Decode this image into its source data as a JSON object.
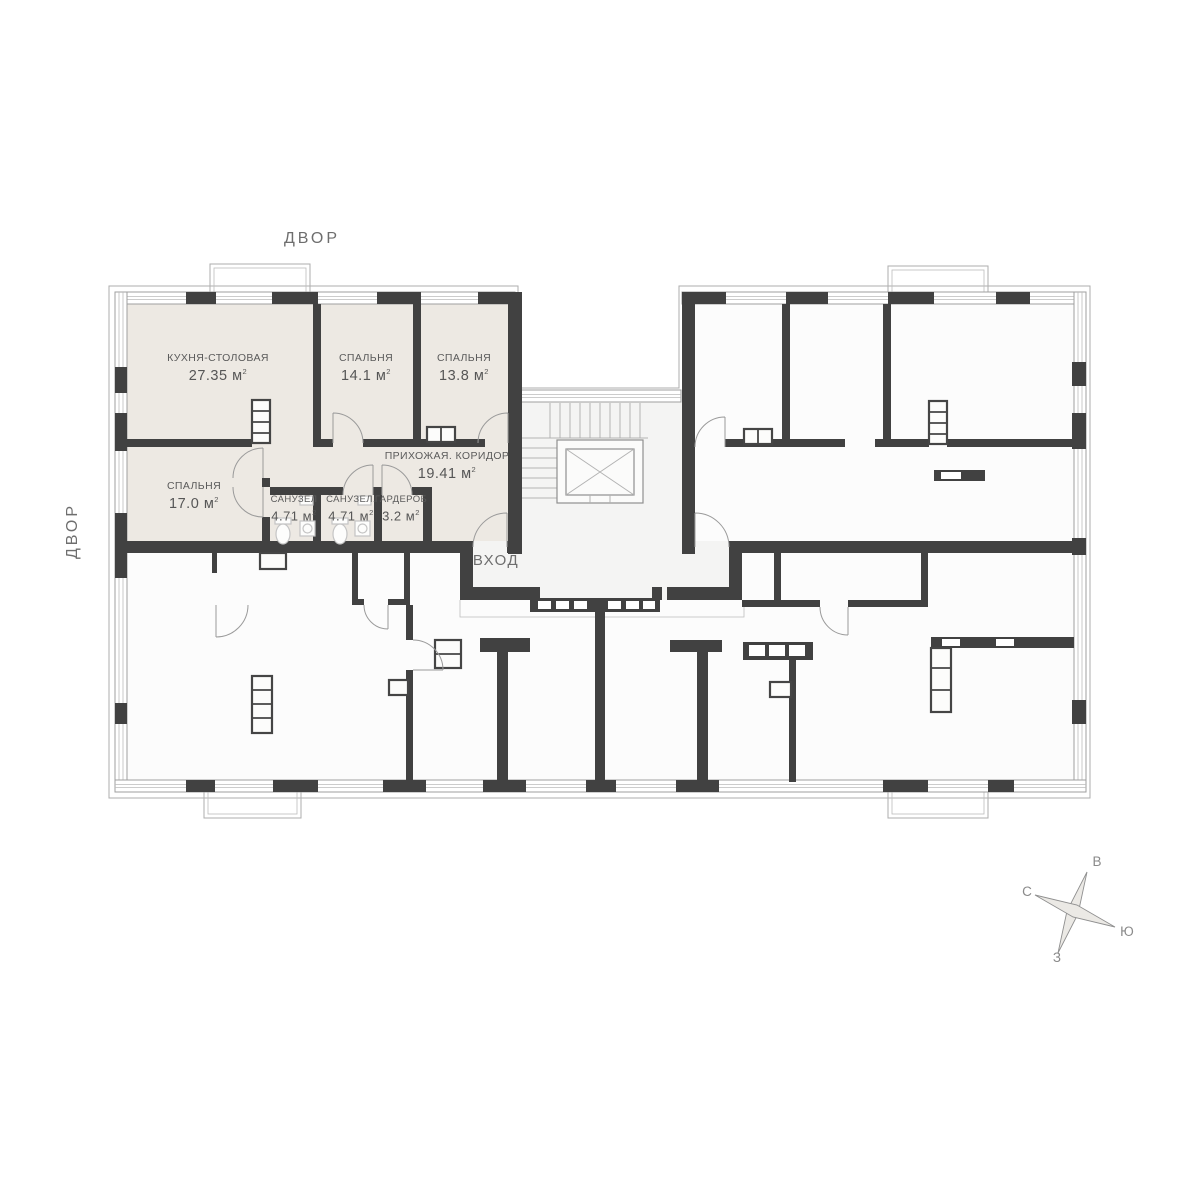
{
  "plan": {
    "courtyard_label_top": "ДВОР",
    "courtyard_label_left": "ДВОР",
    "entrance_label": "ВХОД",
    "area_unit_base": "м",
    "area_unit_sup": "2"
  },
  "apartment": {
    "highlight_color": "#ede9e3",
    "rooms": [
      {
        "id": "kitchen-dining",
        "name": "КУХНЯ-СТОЛОВАЯ",
        "area": "27.35"
      },
      {
        "id": "bedroom-1",
        "name": "СПАЛЬНЯ",
        "area": "14.1"
      },
      {
        "id": "bedroom-2",
        "name": "СПАЛЬНЯ",
        "area": "13.8"
      },
      {
        "id": "bedroom-3",
        "name": "СПАЛЬНЯ",
        "area": "17.0"
      },
      {
        "id": "bathroom-1",
        "name": "САНУЗЕЛ",
        "area": "4.71"
      },
      {
        "id": "bathroom-2",
        "name": "САНУЗЕЛ.",
        "area": "4.71"
      },
      {
        "id": "wardrobe",
        "name": "ГАРДЕРОБ",
        "area": "3.2"
      },
      {
        "id": "hallway",
        "name": "ПРИХОЖАЯ. КОРИДОР",
        "area": "19.41"
      }
    ]
  },
  "compass": {
    "east": "В",
    "north": "С",
    "south": "Ю",
    "west": "З"
  },
  "colors": {
    "wall": "#414141",
    "outline": "#9f9f9f",
    "highlight": "#ede9e3",
    "floor_common": "#f4f4f3",
    "text_primary": "#6e6e6e",
    "text_room": "#5a5a5a"
  }
}
